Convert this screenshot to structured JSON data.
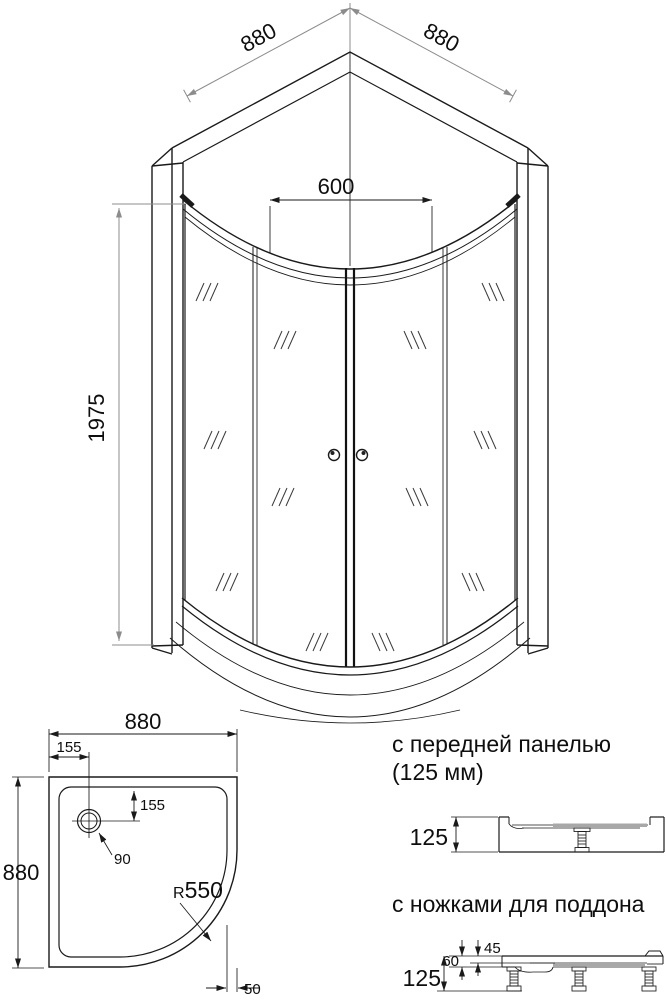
{
  "front_view": {
    "dim_top_left": "880",
    "dim_top_right": "880",
    "dim_opening": "600",
    "dim_height": "1975"
  },
  "plan_view": {
    "dim_width": "880",
    "dim_depth": "880",
    "dim_drain_from_left": "155",
    "dim_drain_from_top": "155",
    "dim_drain_diameter": "90",
    "dim_radius_prefix": "R",
    "dim_radius_value": "550",
    "dim_panel_offset": "50"
  },
  "side_view_front_panel": {
    "title_line1": "с передней панелью",
    "title_line2": "(125 мм)",
    "dim_height": "125"
  },
  "side_view_legs": {
    "title": "с ножками для поддона",
    "dim_basin_depth": "45",
    "dim_tray_height": "60",
    "dim_total_height": "125"
  }
}
